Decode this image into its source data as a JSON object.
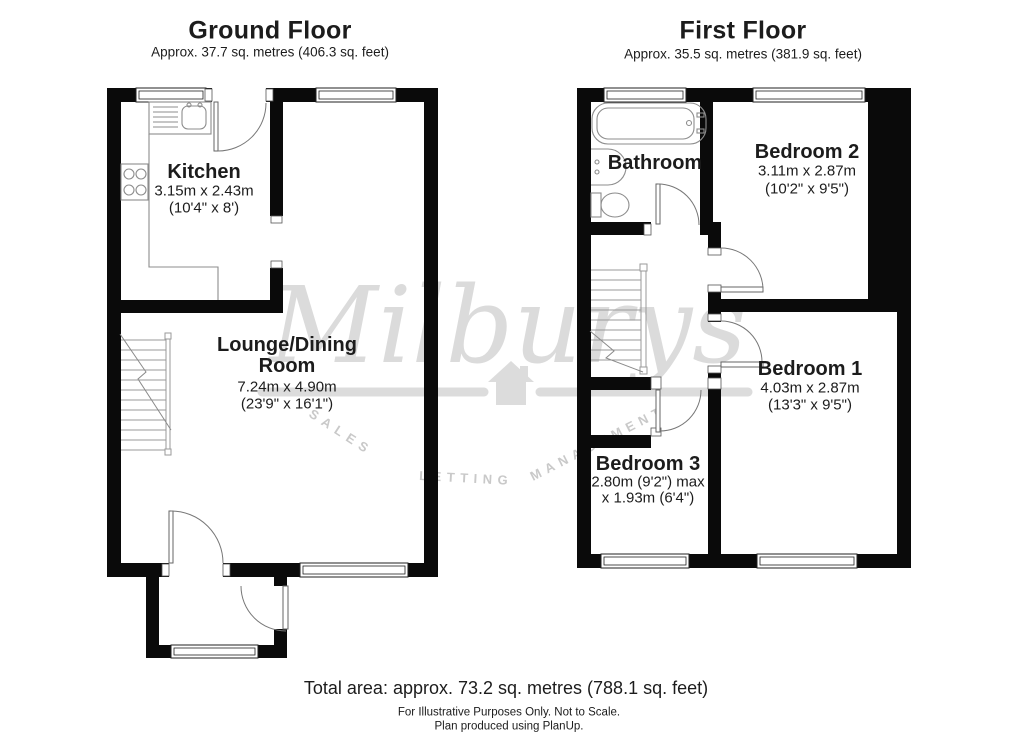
{
  "ground_floor": {
    "title": "Ground Floor",
    "subtitle": "Approx. 37.7 sq. metres (406.3 sq. feet)",
    "rooms": {
      "kitchen": {
        "name": "Kitchen",
        "dims_metric": "3.15m x 2.43m",
        "dims_imperial": "(10'4\" x 8')"
      },
      "lounge": {
        "name_line1": "Lounge/Dining",
        "name_line2": "Room",
        "dims_metric": "7.24m x 4.90m",
        "dims_imperial": "(23'9\" x 16'1\")"
      }
    }
  },
  "first_floor": {
    "title": "First Floor",
    "subtitle": "Approx. 35.5 sq. metres (381.9 sq. feet)",
    "rooms": {
      "bathroom": {
        "name": "Bathroom"
      },
      "bedroom2": {
        "name": "Bedroom 2",
        "dims_metric": "3.11m x 2.87m",
        "dims_imperial": "(10'2\" x 9'5\")"
      },
      "bedroom1": {
        "name": "Bedroom 1",
        "dims_metric": "4.03m x 2.87m",
        "dims_imperial": "(13'3\" x 9'5\")"
      },
      "bedroom3": {
        "name": "Bedroom 3",
        "dims_line1": "2.80m (9'2\") max",
        "dims_line2": "x 1.93m (6'4\")"
      }
    }
  },
  "watermark": {
    "brand": "Milburys",
    "tagline_sales": "SALES",
    "tagline_letting": "LETTING",
    "tagline_management": "MANAGEMENT"
  },
  "footer": {
    "total_area": "Total area: approx. 73.2 sq. metres (788.1 sq. feet)",
    "note1": "For Illustrative Purposes Only. Not to Scale.",
    "note2": "Plan produced using PlanUp."
  },
  "colors": {
    "wall": "#0a0a0a",
    "watermark_gray": "#dbdbdb",
    "tagline_gray": "#c9c9c9"
  }
}
